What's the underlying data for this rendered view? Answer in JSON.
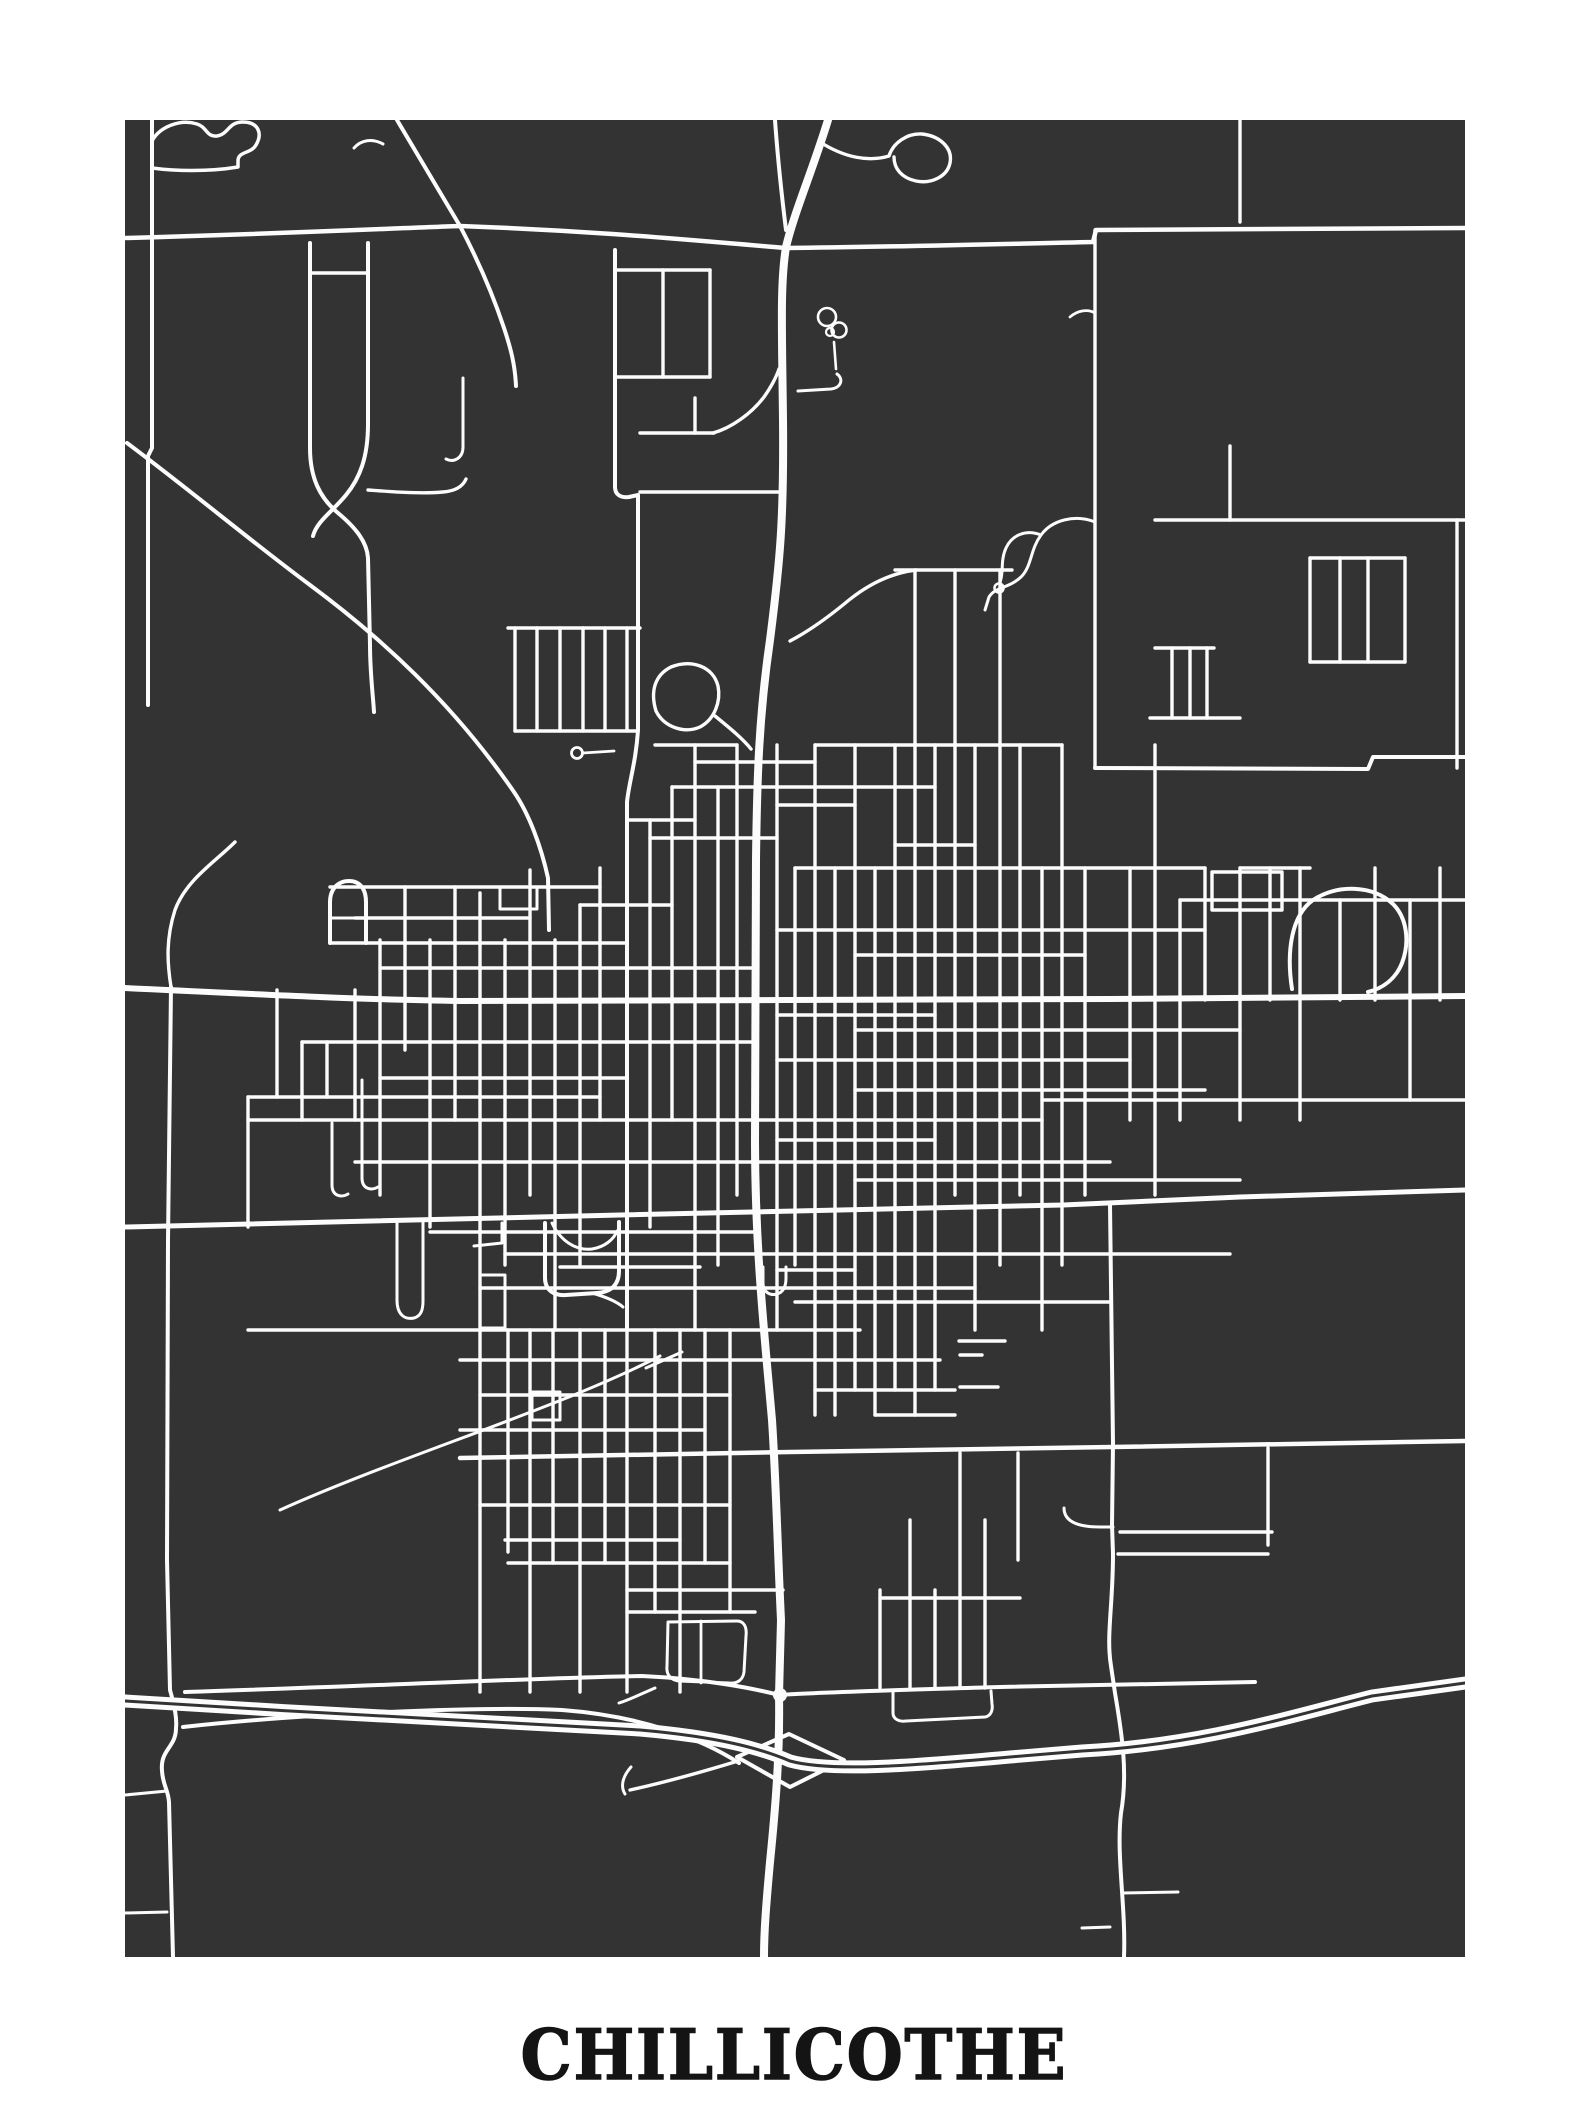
{
  "poster": {
    "title": "CHILLICOTHE",
    "page_bg": "#ffffff",
    "map_bg": "#333333",
    "road_color": "#fcfcfc",
    "title_color": "#141414"
  },
  "frame": {
    "x": 125,
    "y": 120,
    "w": 1340,
    "h": 1837,
    "page_w": 1588,
    "page_h": 2117
  },
  "roads": {
    "major": [
      {
        "d": "M125,238 C300,233 400,228 460,226 C600,231 700,241 786,248 C890,247 1000,244 1093,242 L1096,230 L1465,228",
        "w": 4.5
      },
      {
        "d": "M828,120 C812,172 794,213 786,247 C780,284 782,330 783,420 C784,520 780,562 770,640 C759,716 757,776 756,860 L755,1140 C755,1250 765,1340 772,1420 C776,1480 778,1560 781,1620 L779,1695 C780,1752 776,1802 770,1862 C766,1906 764,1932 764,1957",
        "w": 8
      },
      {
        "d": "M775,120 C778,162 782,198 786,230",
        "w": 4
      },
      {
        "d": "M397,120 L460,226 C480,264 494,298 504,328 C511,349 515,365 516,386",
        "w": 4
      },
      {
        "d": "M127,443 C190,490 252,542 310,585 C380,637 452,702 514,792 C529,814 541,846 548,878 L549,930",
        "w": 4
      },
      {
        "d": "M152,120 L152,448 L148,456 L148,705",
        "w": 4
      },
      {
        "d": "M152,141 C160,126 181,119 197,124 C207,127 206,137 217,136 C229,134 228,122 243,122 C258,122 263,133 256,145 C251,154 238,151 238,161 L238,167 C208,172 174,171 152,168",
        "w": 3.5
      },
      {
        "d": "M310,243 L310,448 C310,478 320,498 338,513 C356,528 367,542 368,558 L370,645 C370,673 373,695 374,712",
        "w": 4
      },
      {
        "d": "M368,243 L368,424 C368,457 360,478 346,495 C332,512 317,521 313,536",
        "w": 4
      },
      {
        "d": "M615,250 L615,487 C615,495 621,498 629,497 L638,495 L638,730 C636,762 629,782 627,802 L627,1330",
        "w": 4
      },
      {
        "d": "M125,988 C250,994 370,1000 460,1001 L786,1000 L1110,999 L1465,996",
        "w": 6
      },
      {
        "d": "M125,1227 L620,1215 L1063,1205 L1240,1197 L1465,1190",
        "w": 5
      },
      {
        "d": "M460,1458 L790,1452 L1112,1447 L1465,1441",
        "w": 4.5
      },
      {
        "d": "M185,1692 C400,1685 560,1677 642,1676 C705,1679 752,1688 779,1695 C820,1692 900,1690 1000,1687 L1255,1682",
        "w": 4
      },
      {
        "d": "M183,1727 C300,1714 480,1706 562,1710 C642,1716 702,1739 739,1763",
        "w": 4
      },
      {
        "d": "M737,1757 L789,1734 L844,1760 L790,1787 Z",
        "w": 4
      },
      {
        "d": "M171,987 L168,1240 L167,1560 L170,1690 C175,1708 177,1719 176,1728 C176,1748 160,1749 162,1771 C163,1786 168,1789 169,1802 L173,1957",
        "w": 4
      },
      {
        "d": "M1110,1205 L1113,1444 L1112,1525 L1113,1554 C1113,1606 1106,1636 1111,1666 L1115,1693 C1122,1734 1128,1773 1121,1813 C1116,1856 1126,1906 1124,1957",
        "w": 4
      },
      {
        "d": "M1095,768 L1368,769 L1373,757 L1465,757",
        "w": 4
      },
      {
        "d": "M1292,989 C1286,950 1292,915 1313,900 C1338,884 1373,885 1393,904 C1407,918 1410,942 1402,963 C1396,978 1384,988 1368,992",
        "w": 4
      }
    ],
    "highway": {
      "d": "M125,1701 C300,1712 500,1723 640,1730 C720,1737 762,1749 790,1761 C830,1772 910,1766 1010,1757 L1082,1751 C1200,1745 1292,1716 1372,1696 L1465,1683",
      "w": 13,
      "divider_w": 3
    },
    "node": {
      "cx": 780,
      "cy": 1695,
      "r": 7
    },
    "minor": [
      {
        "d": "M383,144 C372,138 361,140 354,148",
        "w": 3
      },
      {
        "d": "M368,490 C396,492 421,494 443,492 C456,491 463,486 466,479",
        "w": 3.4
      },
      {
        "d": "M235,842 C215,862 186,880 175,910 C166,938 167,962 171,987",
        "w": 3.4
      },
      {
        "d": "M330,943 L330,902 C330,889 338,881 349,881 C360,881 366,889 366,902 L366,943",
        "w": 4
      },
      {
        "d": "M330,918 L366,918",
        "w": 3
      },
      {
        "d": "M500,887 L537,887 L537,909 L500,909 Z",
        "w": 3
      },
      {
        "d": "M508,628 L640,628",
        "w": 3.4
      },
      {
        "d": "M515,731 L638,731",
        "w": 3.4
      },
      {
        "d": "M583,753 L614,751",
        "w": 2.8
      },
      {
        "d": "M656,711 C650,691 655,675 671,667 C691,659 713,666 718,686 C721,701 715,719 700,727 C684,734 664,727 656,711 Z",
        "w": 3.4
      },
      {
        "d": "M715,716 C731,729 743,739 751,749",
        "w": 3.4
      },
      {
        "d": "M834,342 L836,369",
        "w": 2.6
      },
      {
        "d": "M798,391 L831,389 C841,388 844,379 837,374",
        "w": 3
      },
      {
        "d": "M820,142 C845,158 869,162 889,156 C893,143 907,133 922,134 C940,136 953,148 950,163 C947,177 931,184 916,181 C902,178 894,169 894,157",
        "w": 3.4
      },
      {
        "d": "M790,641 C811,630 831,615 849,600 C869,584 891,573 916,570",
        "w": 3.4
      },
      {
        "d": "M713,433 C731,428 751,414 764,397 C771,387 776,378 779,369",
        "w": 3.4
      },
      {
        "d": "M463,378 L463,447 C463,458 454,463 446,459",
        "w": 3
      },
      {
        "d": "M1095,522 C1075,514 1052,520 1041,535 C1030,550 1032,566 1021,577 C1008,589 996,586 989,597 L985,610",
        "w": 3
      },
      {
        "d": "M1041,535 C1026,529 1012,535 1006,548 C1000,561 1004,573 1000,582",
        "w": 3
      },
      {
        "d": "M1070,317 C1078,310 1088,309 1095,313",
        "w": 2.8
      },
      {
        "d": "M1230,446 L1230,520",
        "w": 3.4
      },
      {
        "d": "M1212,872 L1282,872 L1282,910 L1212,910 Z",
        "w": 3.4
      },
      {
        "d": "M893,1692 L893,1713 C893,1719 899,1722 906,1721 L985,1717 C991,1716 993,1710 992,1704 L991,1691",
        "w": 3
      },
      {
        "d": "M668,1622 L737,1621 C744,1621 747,1627 746,1636 L744,1672 C743,1680 737,1684 729,1683 L679,1681 C671,1680 666,1675 667,1666 Z",
        "w": 3
      },
      {
        "d": "M701,1621 L701,1683",
        "w": 2.8
      },
      {
        "d": "M655,1688 C641,1694 629,1700 619,1703",
        "w": 3
      },
      {
        "d": "M630,1790 C662,1783 702,1772 738,1761",
        "w": 3.4
      },
      {
        "d": "M631,1767 C623,1776 620,1786 625,1794",
        "w": 3
      },
      {
        "d": "M125,1795 L167,1791",
        "w": 3
      },
      {
        "d": "M125,1913 L167,1912",
        "w": 3
      },
      {
        "d": "M1064,1508 C1064,1521 1077,1527 1100,1527 L1113,1527",
        "w": 3
      },
      {
        "d": "M1123,1893 L1178,1892",
        "w": 3
      },
      {
        "d": "M1082,1928 L1110,1927",
        "w": 3
      },
      {
        "d": "M280,1510 C400,1456 560,1408 660,1356",
        "w": 3
      },
      {
        "d": "M646,1368 L682,1352",
        "w": 3
      },
      {
        "d": "M332,1123 L332,1185 C332,1196 341,1198 348,1194",
        "w": 3
      },
      {
        "d": "M362,1080 L362,1178 C362,1189 371,1191 378,1187",
        "w": 3
      },
      {
        "d": "M397,1223 L397,1300 C397,1314 404,1320 414,1318 C421,1316 423,1310 423,1301 L423,1223",
        "w": 3
      },
      {
        "d": "M480,1275 L505,1275 L505,1328 L480,1328 Z",
        "w": 3
      },
      {
        "d": "M502,1223 L502,1243 L474,1246",
        "w": 3
      },
      {
        "d": "M545,1223 L545,1278 C545,1290 554,1296 566,1295 L597,1293 C612,1292 619,1284 619,1271 L619,1222",
        "w": 4
      },
      {
        "d": "M552,1223 C560,1240 575,1251 592,1249 C605,1247 614,1239 617,1231",
        "w": 3
      },
      {
        "d": "M592,1293 C606,1297 616,1301 623,1307",
        "w": 3
      },
      {
        "d": "M532,1392 L560,1392 L560,1420 L532,1420 Z",
        "w": 3
      },
      {
        "d": "M763,1267 L763,1283 C763,1292 770,1296 777,1294 C784,1292 786,1285 786,1278 L786,1267",
        "w": 3
      }
    ],
    "circles": [
      {
        "cx": 827,
        "cy": 317,
        "r": 9,
        "w": 2.6
      },
      {
        "cx": 839,
        "cy": 330,
        "r": 7.5,
        "w": 2.6
      },
      {
        "cx": 830,
        "cy": 332,
        "r": 4,
        "w": 2.2
      },
      {
        "cx": 577,
        "cy": 753,
        "r": 5.5,
        "w": 2.8
      },
      {
        "cx": 999,
        "cy": 588,
        "r": 4.5,
        "w": 2.6
      }
    ],
    "h": [
      [
        270,
        615,
        710
      ],
      [
        377,
        615,
        710
      ],
      [
        433,
        640,
        714
      ],
      [
        492,
        640,
        783
      ],
      [
        520,
        1155,
        1465
      ],
      [
        570,
        895,
        1012
      ],
      [
        558,
        1310,
        1405
      ],
      [
        662,
        1310,
        1405
      ],
      [
        648,
        1155,
        1214
      ],
      [
        718,
        1150,
        1240
      ],
      [
        273,
        310,
        368
      ],
      [
        745,
        655,
        737
      ],
      [
        745,
        815,
        1062
      ],
      [
        762,
        695,
        815
      ],
      [
        787,
        672,
        935
      ],
      [
        805,
        777,
        855
      ],
      [
        820,
        627,
        695
      ],
      [
        838,
        650,
        777
      ],
      [
        845,
        895,
        975
      ],
      [
        868,
        795,
        1205
      ],
      [
        868,
        1240,
        1310
      ],
      [
        887,
        330,
        600
      ],
      [
        900,
        1180,
        1465
      ],
      [
        905,
        580,
        672
      ],
      [
        918,
        355,
        530
      ],
      [
        930,
        777,
        1205
      ],
      [
        943,
        330,
        627
      ],
      [
        955,
        855,
        1085
      ],
      [
        968,
        380,
        755
      ],
      [
        1015,
        777,
        935
      ],
      [
        1030,
        855,
        1240
      ],
      [
        1042,
        302,
        755
      ],
      [
        1060,
        777,
        1130
      ],
      [
        1078,
        380,
        627
      ],
      [
        1090,
        855,
        1205
      ],
      [
        1097,
        248,
        600
      ],
      [
        1100,
        1042,
        1465
      ],
      [
        1120,
        248,
        1042
      ],
      [
        1140,
        777,
        935
      ],
      [
        1162,
        355,
        1110
      ],
      [
        1180,
        855,
        1240
      ],
      [
        1232,
        430,
        755
      ],
      [
        1254,
        505,
        1230
      ],
      [
        1267,
        560,
        700
      ],
      [
        1270,
        777,
        855
      ],
      [
        1288,
        480,
        975
      ],
      [
        1302,
        795,
        1110
      ],
      [
        1330,
        248,
        860
      ],
      [
        1341,
        959,
        1005
      ],
      [
        1355,
        960,
        982
      ],
      [
        1360,
        460,
        940
      ],
      [
        1387,
        960,
        998
      ],
      [
        1390,
        815,
        955
      ],
      [
        1395,
        480,
        730
      ],
      [
        1415,
        875,
        955
      ],
      [
        1430,
        460,
        705
      ],
      [
        1505,
        480,
        730
      ],
      [
        1532,
        1120,
        1272
      ],
      [
        1540,
        505,
        680
      ],
      [
        1554,
        1118,
        1268
      ],
      [
        1563,
        508,
        730
      ],
      [
        1590,
        627,
        783
      ],
      [
        1598,
        880,
        1020
      ],
      [
        1612,
        627,
        755
      ]
    ],
    "v": [
      [
        1240,
        120,
        222
      ],
      [
        248,
        1097,
        1227
      ],
      [
        277,
        990,
        1097
      ],
      [
        302,
        1042,
        1120
      ],
      [
        327,
        1042,
        1097
      ],
      [
        355,
        990,
        1120
      ],
      [
        380,
        940,
        1195
      ],
      [
        405,
        887,
        1050
      ],
      [
        430,
        940,
        1227
      ],
      [
        455,
        887,
        1120
      ],
      [
        480,
        893,
        1330
      ],
      [
        505,
        940,
        1265
      ],
      [
        530,
        870,
        1195
      ],
      [
        555,
        940,
        1330
      ],
      [
        580,
        905,
        1265
      ],
      [
        600,
        868,
        1120
      ],
      [
        650,
        820,
        1227
      ],
      [
        663,
        270,
        377
      ],
      [
        672,
        787,
        1120
      ],
      [
        695,
        398,
        433
      ],
      [
        695,
        745,
        1330
      ],
      [
        710,
        270,
        377
      ],
      [
        718,
        787,
        1265
      ],
      [
        737,
        745,
        1195
      ],
      [
        777,
        745,
        1330
      ],
      [
        795,
        868,
        1265
      ],
      [
        815,
        745,
        1415
      ],
      [
        835,
        868,
        1415
      ],
      [
        855,
        745,
        1390
      ],
      [
        875,
        868,
        1415
      ],
      [
        895,
        745,
        1390
      ],
      [
        915,
        570,
        1415
      ],
      [
        935,
        745,
        1390
      ],
      [
        955,
        570,
        1195
      ],
      [
        975,
        745,
        1330
      ],
      [
        1000,
        570,
        1265
      ],
      [
        1020,
        745,
        1195
      ],
      [
        1042,
        868,
        1330
      ],
      [
        1062,
        745,
        1265
      ],
      [
        1085,
        868,
        1195
      ],
      [
        1095,
        230,
        768
      ],
      [
        1130,
        868,
        1120
      ],
      [
        1155,
        745,
        1195
      ],
      [
        1172,
        648,
        718
      ],
      [
        1190,
        648,
        718
      ],
      [
        1207,
        648,
        718
      ],
      [
        1180,
        900,
        1120
      ],
      [
        1205,
        868,
        1000
      ],
      [
        1240,
        868,
        1120
      ],
      [
        1268,
        1448,
        1545
      ],
      [
        1270,
        868,
        1000
      ],
      [
        1300,
        868,
        1120
      ],
      [
        1310,
        558,
        662
      ],
      [
        1340,
        558,
        662
      ],
      [
        1368,
        558,
        662
      ],
      [
        1405,
        558,
        662
      ],
      [
        1340,
        900,
        1000
      ],
      [
        1375,
        868,
        1000
      ],
      [
        1410,
        900,
        1100
      ],
      [
        1440,
        868,
        1000
      ],
      [
        1457,
        520,
        768
      ],
      [
        515,
        628,
        731
      ],
      [
        537,
        628,
        731
      ],
      [
        560,
        628,
        731
      ],
      [
        583,
        628,
        731
      ],
      [
        605,
        628,
        731
      ],
      [
        627,
        628,
        731
      ],
      [
        480,
        1330,
        1692
      ],
      [
        508,
        1330,
        1552
      ],
      [
        530,
        1330,
        1692
      ],
      [
        553,
        1330,
        1563
      ],
      [
        580,
        1330,
        1692
      ],
      [
        605,
        1330,
        1563
      ],
      [
        627,
        1330,
        1692
      ],
      [
        655,
        1330,
        1612
      ],
      [
        680,
        1330,
        1692
      ],
      [
        705,
        1330,
        1563
      ],
      [
        730,
        1330,
        1612
      ],
      [
        880,
        1590,
        1688
      ],
      [
        910,
        1520,
        1688
      ],
      [
        935,
        1590,
        1688
      ],
      [
        960,
        1453,
        1688
      ],
      [
        985,
        1520,
        1688
      ],
      [
        1018,
        1453,
        1560
      ]
    ]
  }
}
